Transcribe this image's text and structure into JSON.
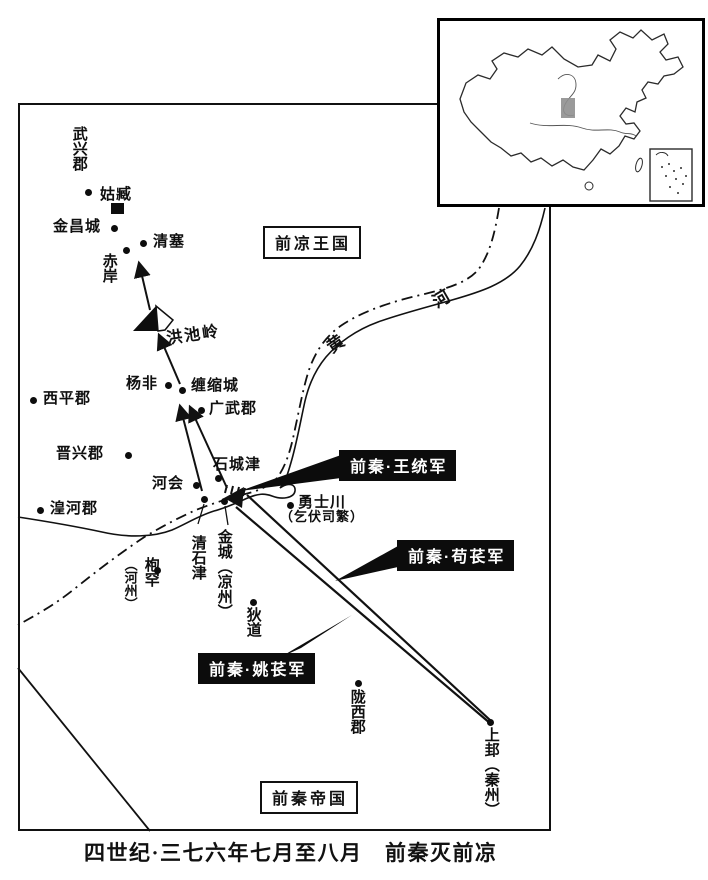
{
  "caption": "四世纪·三七六年七月至八月　前秦灭前凉",
  "region_boxes": {
    "former_liang": "前凉王国",
    "former_qin": "前秦帝国"
  },
  "army_boxes": [
    {
      "label": "前秦·王统军"
    },
    {
      "label": "前秦·苟苌军"
    },
    {
      "label": "前秦·姚苌军"
    }
  ],
  "river": {
    "chars": [
      "黄",
      "河"
    ]
  },
  "mountain": {
    "label": "洪池岭"
  },
  "colors": {
    "ink": "#111111",
    "paper": "#ffffff",
    "army_box_bg": "#0c0c0c",
    "army_box_text": "#ffffff",
    "locator_shade": "#8f8f8f"
  },
  "places": [
    {
      "name": "武兴郡",
      "marker": "dot",
      "x": 88,
      "y": 192,
      "labels": [
        {
          "text": "武兴郡",
          "x": 71,
          "y": 126,
          "orient": "v"
        }
      ]
    },
    {
      "name": "姑臧",
      "marker": "square",
      "x": 117,
      "y": 208,
      "labels": [
        {
          "text": "姑臧",
          "x": 100,
          "y": 187,
          "orient": "h"
        }
      ]
    },
    {
      "name": "金昌城",
      "marker": "dot",
      "x": 114,
      "y": 228,
      "labels": [
        {
          "text": "金昌城",
          "x": 53,
          "y": 219,
          "orient": "h"
        }
      ]
    },
    {
      "name": "清塞",
      "marker": "dot",
      "x": 143,
      "y": 243,
      "labels": [
        {
          "text": "清塞",
          "x": 153,
          "y": 234,
          "orient": "h"
        }
      ]
    },
    {
      "name": "赤岸",
      "marker": "dot",
      "x": 126,
      "y": 250,
      "labels": [
        {
          "text": "赤岸",
          "x": 101,
          "y": 253,
          "orient": "v"
        }
      ]
    },
    {
      "name": "杨非",
      "marker": "dot",
      "x": 168,
      "y": 385,
      "labels": [
        {
          "text": "杨非",
          "x": 126,
          "y": 376,
          "orient": "h"
        }
      ]
    },
    {
      "name": "缠缩城",
      "marker": "dot",
      "x": 182,
      "y": 390,
      "labels": [
        {
          "text": "缠缩城",
          "x": 191,
          "y": 378,
          "orient": "h"
        }
      ]
    },
    {
      "name": "广武郡",
      "marker": "dot",
      "x": 201,
      "y": 410,
      "labels": [
        {
          "text": "广武郡",
          "x": 209,
          "y": 401,
          "orient": "h"
        }
      ]
    },
    {
      "name": "西平郡",
      "marker": "dot",
      "x": 33,
      "y": 400,
      "labels": [
        {
          "text": "西平郡",
          "x": 43,
          "y": 391,
          "orient": "h"
        }
      ]
    },
    {
      "name": "晋兴郡",
      "marker": "dot",
      "x": 128,
      "y": 455,
      "labels": [
        {
          "text": "晋兴郡",
          "x": 56,
          "y": 446,
          "orient": "h"
        }
      ]
    },
    {
      "name": "河会",
      "marker": "dot",
      "x": 196,
      "y": 485,
      "labels": [
        {
          "text": "河会",
          "x": 152,
          "y": 476,
          "orient": "h"
        }
      ]
    },
    {
      "name": "石城津",
      "marker": "dot",
      "x": 218,
      "y": 478,
      "labels": [
        {
          "text": "石城津",
          "x": 213,
          "y": 457,
          "orient": "h"
        }
      ]
    },
    {
      "name": "清石津",
      "marker": "dot",
      "x": 204,
      "y": 499,
      "labels": [
        {
          "text": "清石津",
          "x": 190,
          "y": 535,
          "orient": "v"
        }
      ]
    },
    {
      "name": "金城（凉州）",
      "marker": "dot",
      "x": 224,
      "y": 501,
      "labels": [
        {
          "text": "金城（凉州）",
          "x": 216,
          "y": 529,
          "orient": "v"
        }
      ]
    },
    {
      "name": "湟河郡",
      "marker": "dot",
      "x": 40,
      "y": 510,
      "labels": [
        {
          "text": "湟河郡",
          "x": 50,
          "y": 501,
          "orient": "h"
        }
      ]
    },
    {
      "name": "枹罕（河州）",
      "marker": "dot",
      "x": 157,
      "y": 570,
      "labels": [
        {
          "text": "枹罕",
          "x": 143,
          "y": 557,
          "orient": "v"
        },
        {
          "text": "（河州）",
          "x": 123,
          "y": 558,
          "orient": "v",
          "size": 13
        }
      ]
    },
    {
      "name": "狄道",
      "marker": "dot",
      "x": 253,
      "y": 602,
      "labels": [
        {
          "text": "狄道",
          "x": 245,
          "y": 607,
          "orient": "v"
        }
      ]
    },
    {
      "name": "勇士川（乞伏司繁）",
      "marker": "dot",
      "x": 290,
      "y": 505,
      "labels": [
        {
          "text": "勇士川",
          "x": 298,
          "y": 495,
          "orient": "h"
        },
        {
          "text": "（乞伏司繁）",
          "x": 280,
          "y": 510,
          "orient": "h",
          "size": 13
        }
      ]
    },
    {
      "name": "陇西郡",
      "marker": "dot",
      "x": 358,
      "y": 683,
      "labels": [
        {
          "text": "陇西郡",
          "x": 349,
          "y": 689,
          "orient": "v"
        }
      ]
    },
    {
      "name": "上邽（秦州）",
      "marker": "dot",
      "x": 490,
      "y": 722,
      "labels": [
        {
          "text": "上邽（秦州）",
          "x": 483,
          "y": 727,
          "orient": "v"
        }
      ]
    }
  ],
  "routes_depicted": [
    {
      "army": "前秦·王统军",
      "pointer_to": "黄河渡口（石城津·清石津一带）"
    },
    {
      "army": "前秦·苟苌军",
      "from": "上邽（秦州）",
      "to": "金城渡口"
    },
    {
      "army": "前秦·姚苌军",
      "from": "上邽（秦州）",
      "to": "金城渡口"
    },
    {
      "advance": "渡口 → 缠缩城 → 洪池岭 → 清塞（姑臧方向）"
    }
  ]
}
